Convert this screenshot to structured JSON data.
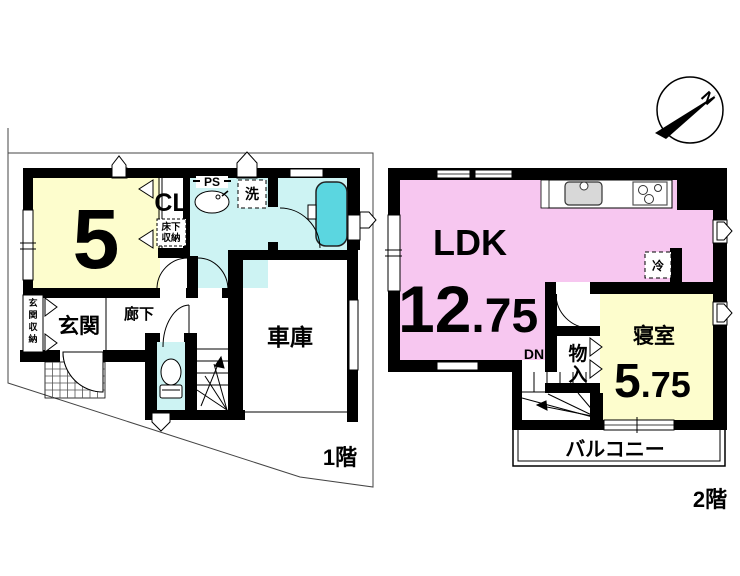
{
  "title": "floor-plan",
  "colors": {
    "wall": "#000000",
    "room_yellow": "#fdfdcd",
    "room_pink": "#f7c7f0",
    "wet_cyan": "#cdf3f3",
    "tub_cyan": "#5bd6e0",
    "sink_gray": "#d8d8d8",
    "boundary_gray": "#444444"
  },
  "floor1": {
    "label": "1階",
    "room5_size": "5",
    "closet": "CL",
    "underfloor_line1": "床下",
    "underfloor_line2": "収納",
    "pipe_space": "PS",
    "laundry": "洗",
    "entrance": "玄関",
    "entrance_storage": [
      "玄",
      "関",
      "収",
      "納"
    ],
    "hallway": "廊下",
    "garage": "車庫"
  },
  "floor2": {
    "label": "2階",
    "ldk": "LDK",
    "ldk_size_int": "12",
    "ldk_size_dec": ".75",
    "fridge": "冷",
    "bedroom": "寝室",
    "bedroom_size_int": "5",
    "bedroom_size_dec": ".75",
    "storage_line1": "物",
    "storage_line2": "入",
    "stairs_down": "DN",
    "balcony": "バルコニー"
  },
  "compass": {
    "north": "N"
  }
}
